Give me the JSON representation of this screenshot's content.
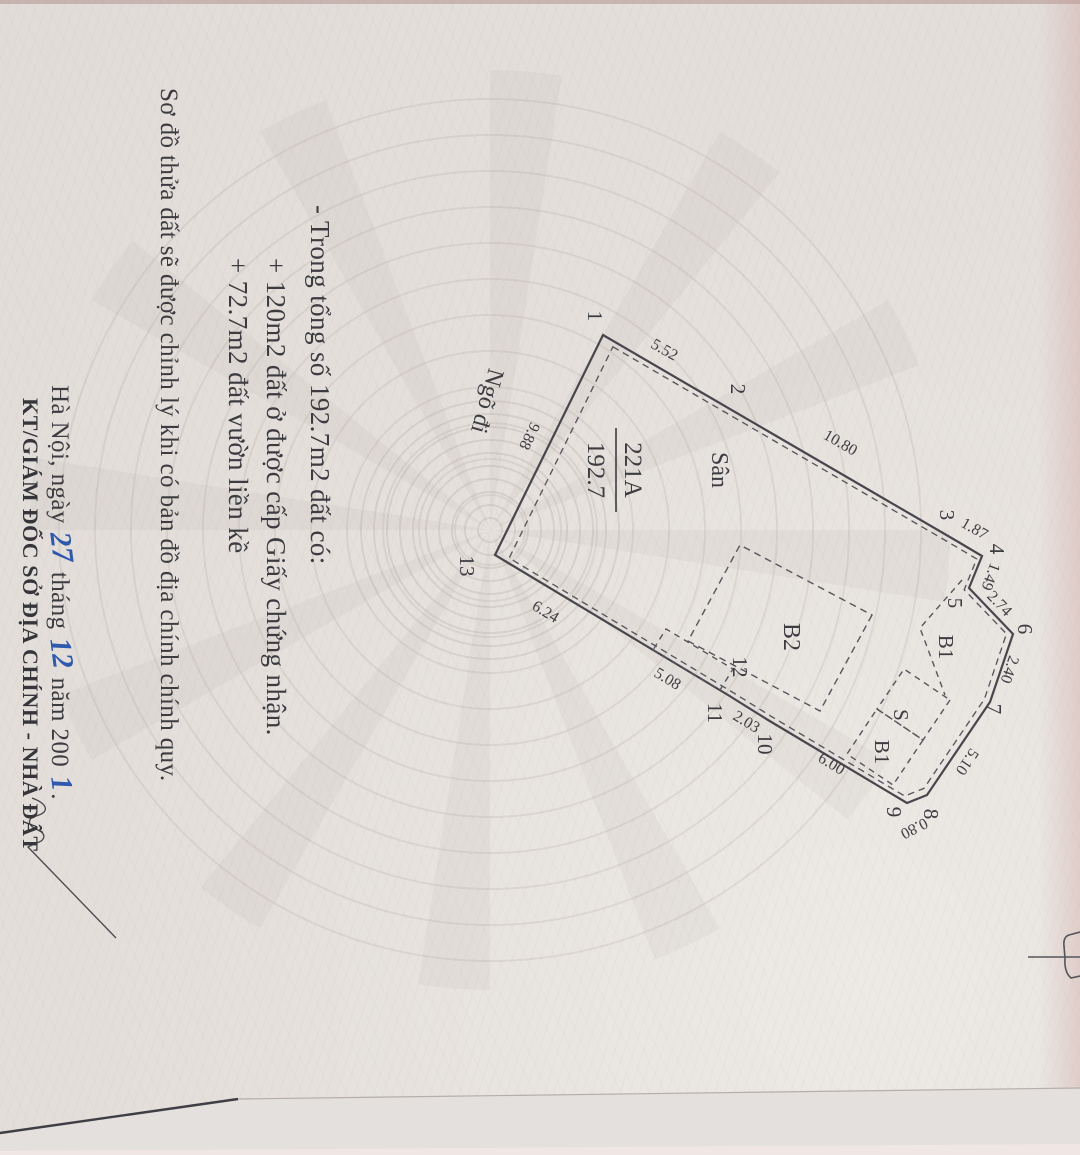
{
  "notes": {
    "line1": "- Trong tổng số 192.7m2 đất có:",
    "line2": "+ 120m2 đất ở được cấp Giấy chứng nhận.",
    "line3": "+ 72.7m2 đất vườn liền kề"
  },
  "footer": {
    "revision_note": "Sơ đồ thửa đất sẽ được chỉnh lý khi có bản đồ địa chính chính quy.",
    "date_prefix": "Hà Nội, ngày",
    "day": "27",
    "month_label": "tháng",
    "month": "12",
    "year_label": "năm 200",
    "year_digit": "1",
    "period": ".",
    "signer_title": "KT/GIÁM ĐỐC SỞ ĐỊA CHÍNH - NHÀ ĐẤT"
  },
  "plot": {
    "parcel_number": "221A",
    "area": "192.7",
    "vertices": [
      "1",
      "2",
      "3",
      "4",
      "5",
      "6",
      "7",
      "8",
      "9",
      "10",
      "11",
      "12",
      "13"
    ],
    "dims": {
      "s552": "5.52",
      "s1080": "10.80",
      "s187": "1.87",
      "s149": "1.49",
      "s274": "2.74",
      "s240": "2.40",
      "s510": "5.10",
      "s080": "0.80",
      "s600": "6.00",
      "s203": "2.03",
      "s508": "5.08",
      "s624": "6.24",
      "s988": "9.88"
    },
    "regions": {
      "san": "Sân",
      "b2": "B2",
      "b1_top": "B1",
      "s": "S",
      "b1_small": "B1",
      "ngo_di": "Ngõ đi"
    }
  }
}
